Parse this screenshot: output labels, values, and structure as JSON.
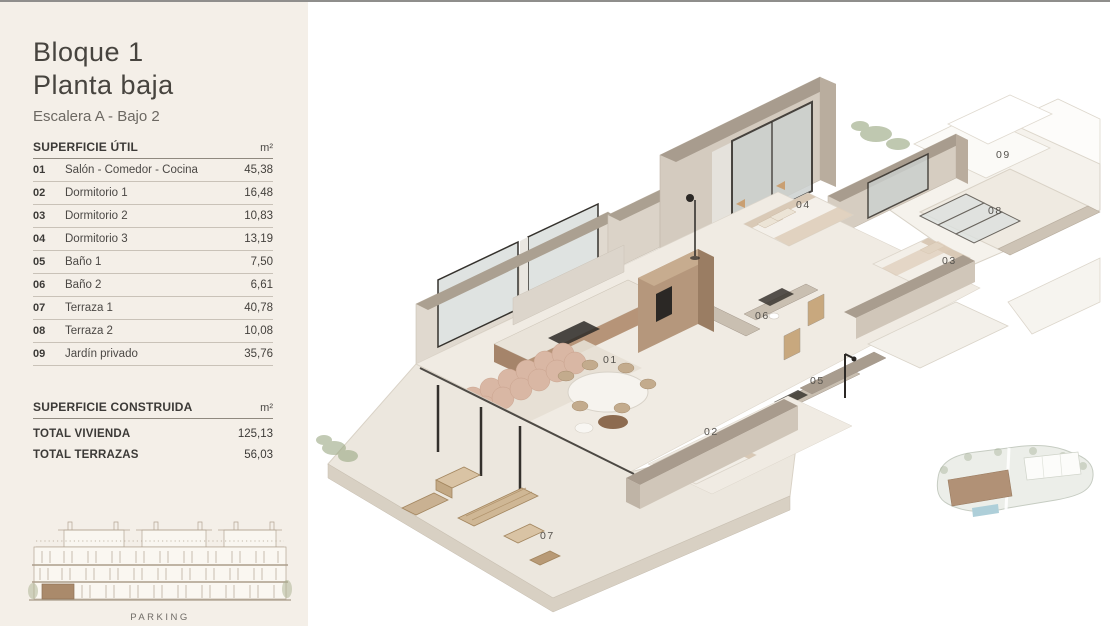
{
  "document": {
    "title_line1": "Bloque 1",
    "title_line2": "Planta baja",
    "subtitle": "Escalera A - Bajo 2"
  },
  "surface_table": {
    "header": "SUPERFICIE ÚTIL",
    "unit": "m²",
    "rows": [
      {
        "num": "01",
        "name": "Salón - Comedor - Cocina",
        "value": "45,38"
      },
      {
        "num": "02",
        "name": "Dormitorio 1",
        "value": "16,48"
      },
      {
        "num": "03",
        "name": "Dormitorio 2",
        "value": "10,83"
      },
      {
        "num": "04",
        "name": "Dormitorio 3",
        "value": "13,19"
      },
      {
        "num": "05",
        "name": "Baño 1",
        "value": "7,50"
      },
      {
        "num": "06",
        "name": "Baño 2",
        "value": "6,61"
      },
      {
        "num": "07",
        "name": "Terraza 1",
        "value": "40,78"
      },
      {
        "num": "08",
        "name": "Terraza 2",
        "value": "10,08"
      },
      {
        "num": "09",
        "name": "Jardín privado",
        "value": "35,76"
      }
    ]
  },
  "built_table": {
    "header": "SUPERFICIE CONSTRUIDA",
    "unit": "m²",
    "rows": [
      {
        "label": "TOTAL VIVIENDA",
        "value": "125,13"
      },
      {
        "label": "TOTAL TERRAZAS",
        "value": "56,03"
      }
    ]
  },
  "elevation": {
    "caption": "PARKING"
  },
  "plan": {
    "room_labels": [
      {
        "num": "01"
      },
      {
        "num": "02"
      },
      {
        "num": "03"
      },
      {
        "num": "04"
      },
      {
        "num": "05"
      },
      {
        "num": "06"
      },
      {
        "num": "07"
      },
      {
        "num": "08"
      },
      {
        "num": "09"
      }
    ]
  },
  "colors": {
    "sidebar_bg": "#f4efe8",
    "text_dark": "#3c3a37",
    "text_mid": "#6c6862",
    "rule_dark": "#8f897f",
    "rule_light": "#c9c2b8",
    "top_strip": "#8f8e8c",
    "wall_face": "#d4cbbf",
    "wall_top": "#a89c8e",
    "floor": "#f0ebe3",
    "wood": "#b69478",
    "sofa": "#d9b7a4",
    "greenery": "#9aa883",
    "terrace": "#ece7de",
    "highlight_brown": "#aa8a6b",
    "pool": "#aecfd9",
    "glass_frame": "#2e2b27"
  }
}
